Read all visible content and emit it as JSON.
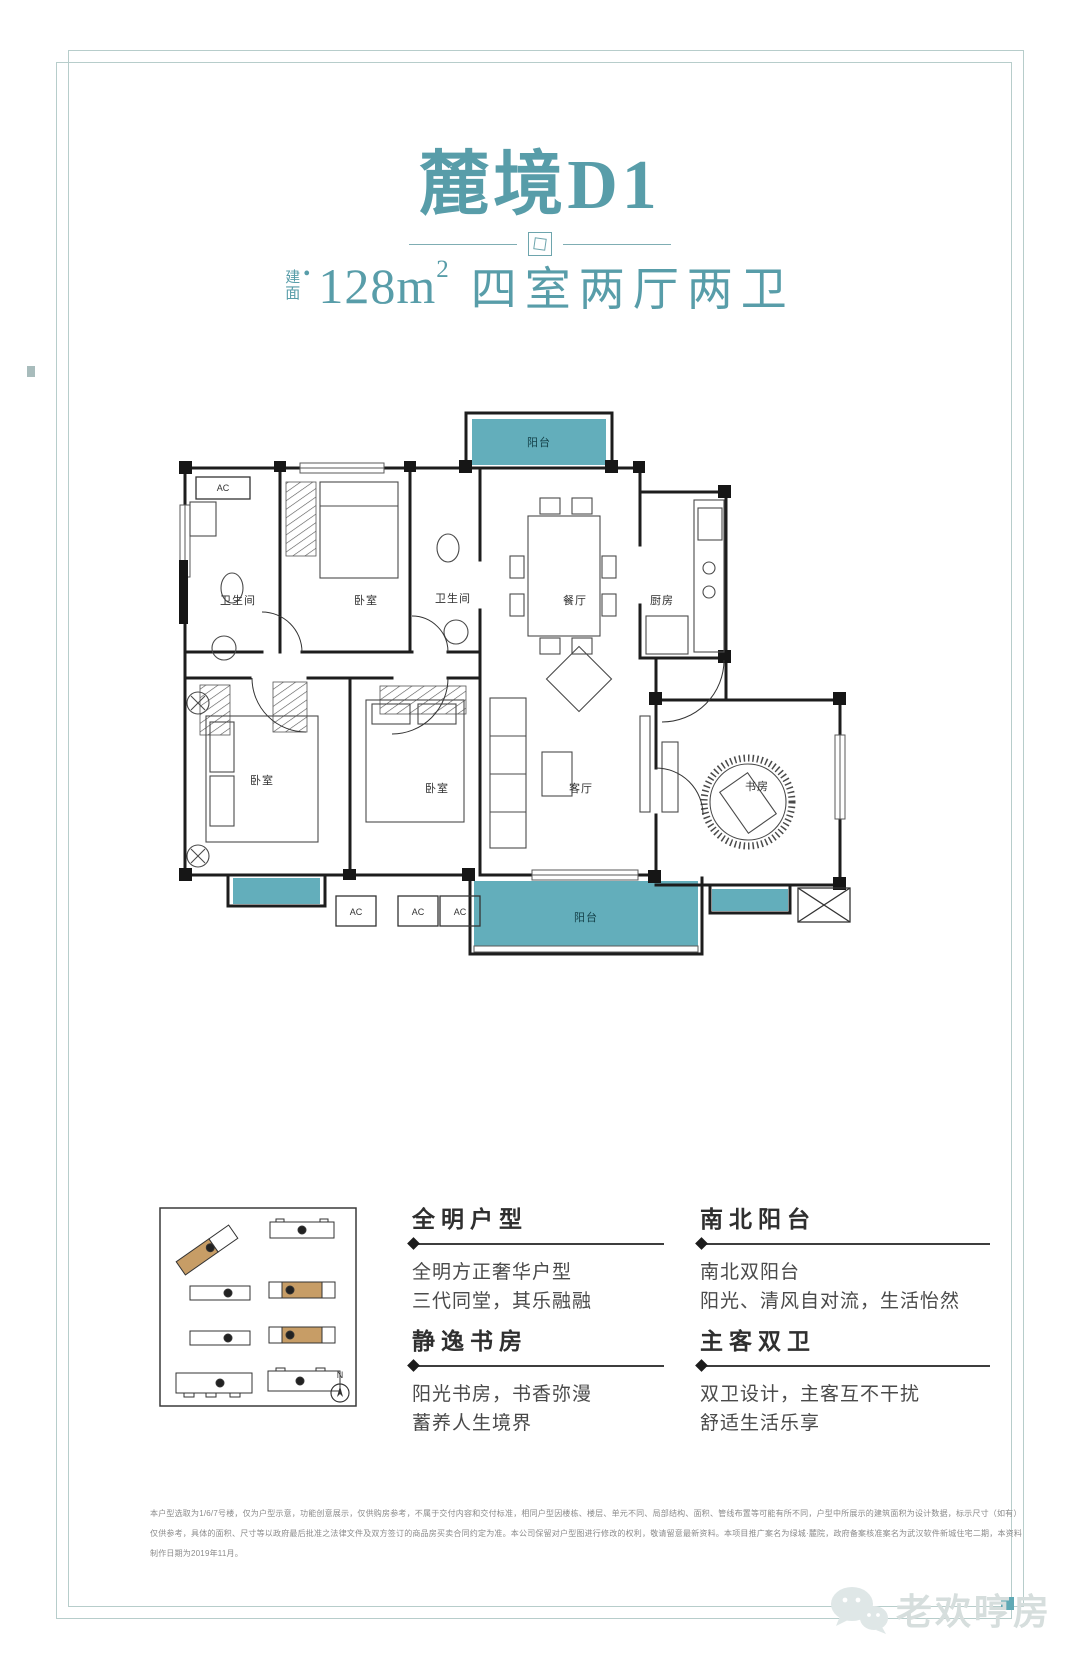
{
  "accent": {
    "teal_text": "#589da9",
    "balcony_fill": "#63aebb",
    "frame_line": "#b7cdcb",
    "tan_highlight": "#c79d66"
  },
  "title": {
    "text": "麓境D1"
  },
  "subtitle": {
    "stack_top": "建",
    "stack_bottom": "面",
    "bullet": "•",
    "area": "128",
    "unit": "m",
    "sup": "2",
    "rooms": "四室两厅两卫"
  },
  "floorplan": {
    "rooms": {
      "balcony_top": "阳台",
      "bath1": "卫生间",
      "bedroom_top": "卧室",
      "bath2": "卫生间",
      "dining": "餐厅",
      "kitchen": "厨房",
      "bedroom_left": "卧室",
      "bedroom_mid": "卧室",
      "living": "客厅",
      "study": "书房",
      "balcony_bottom": "阳台"
    },
    "ac_label": "AC"
  },
  "siteplan": {
    "compass": "N"
  },
  "features": [
    {
      "title": "全明户型",
      "lines": [
        "全明方正奢华户型",
        "三代同堂，其乐融融"
      ]
    },
    {
      "title": "南北阳台",
      "lines": [
        "南北双阳台",
        "阳光、清风自对流，生活怡然"
      ]
    },
    {
      "title": "静逸书房",
      "lines": [
        "阳光书房，书香弥漫",
        "蓄养人生境界"
      ]
    },
    {
      "title": "主客双卫",
      "lines": [
        "双卫设计，主客互不干扰",
        "舒适生活乐享"
      ]
    }
  ],
  "disclaimer": {
    "lines": [
      "本户型选取为1/6/7号楼，仅为户型示意，功能创意展示，仅供购房参考，不属于交付内容和交付标准，相同户型因楼栋、楼层、单元不同、局部结构、面积、管线布置等可能有所不同，户型中所展示的建筑面积为设计数据，标示尺寸（如有）",
      "仅供参考，具体的面积、尺寸等以政府最后批准之法律文件及双方签订的商品房买卖合同约定为准。本公司保留对户型图进行修改的权利，敬请留意最新资料。本项目推广案名为绿城·麓院，政府备案核准案名为武汉软件新城住宅二期，本资料",
      "制作日期为2019年11月。"
    ]
  },
  "watermark": {
    "text": "老欢哼房"
  }
}
